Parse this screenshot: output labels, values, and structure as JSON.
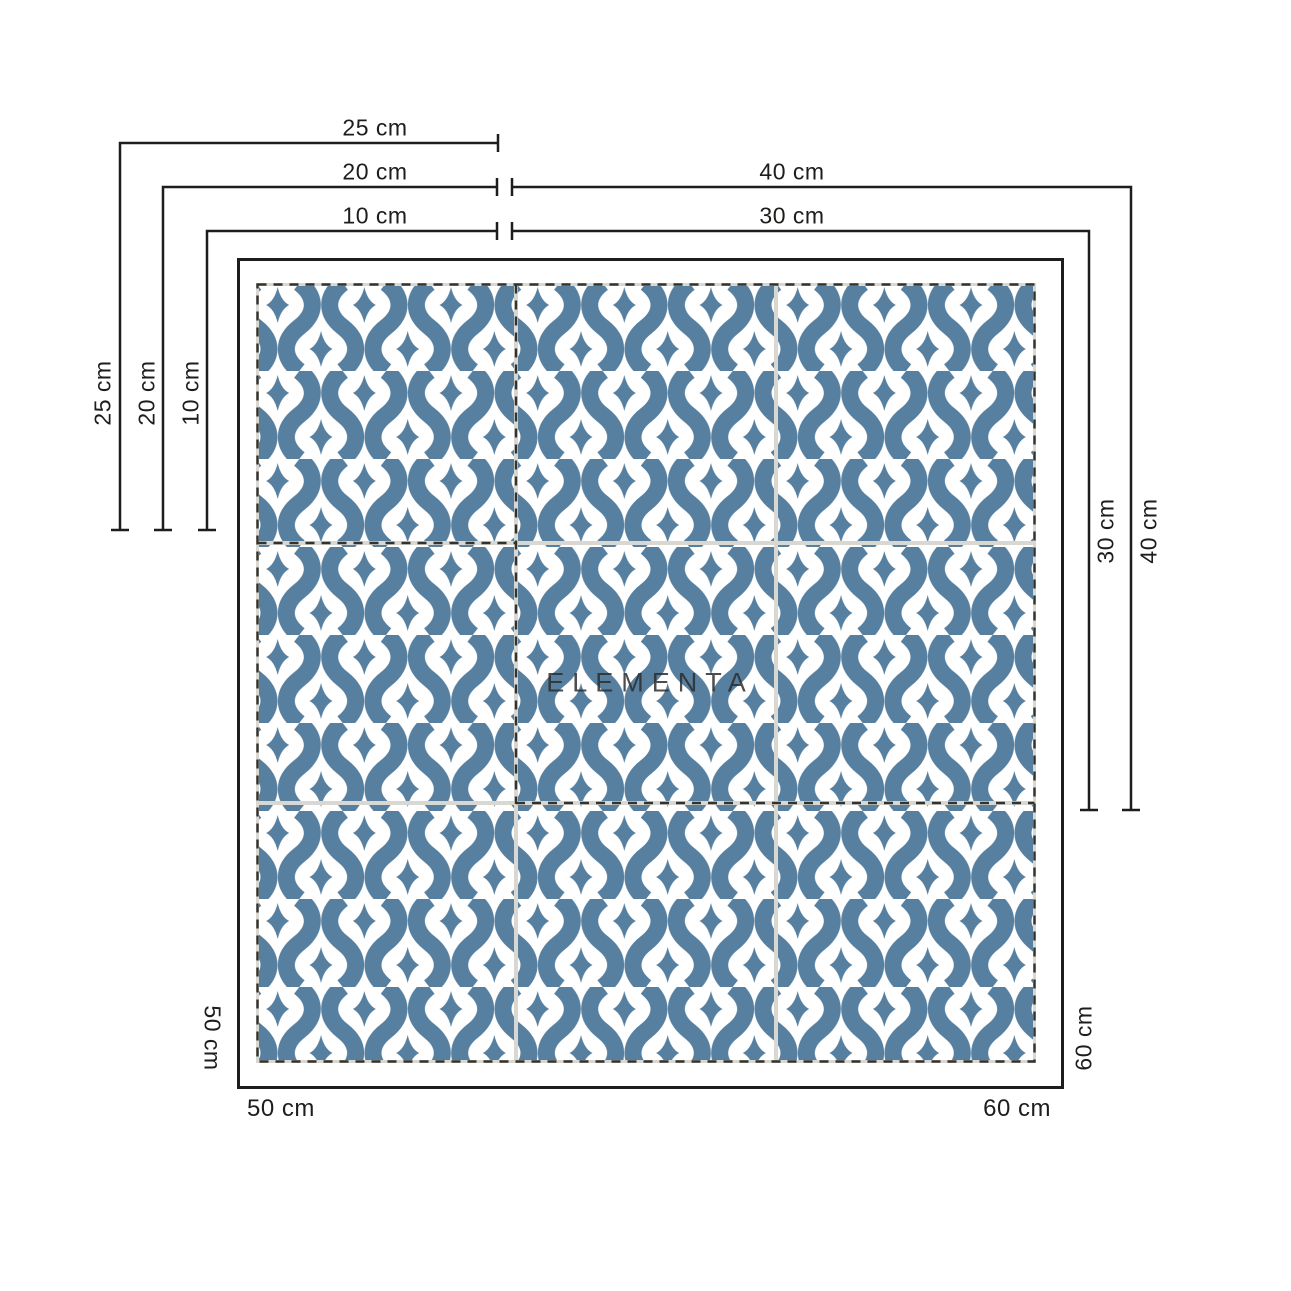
{
  "watermark": {
    "text": "ELEMENTA"
  },
  "colors": {
    "pattern_blue": "#567fa0",
    "grout_gray": "#d8d7d2",
    "line_black": "#1d1d1b",
    "dash_dark": "#33322c",
    "tile_white": "#ffffff"
  },
  "tile_sheet": {
    "grid": "3x3 tiles",
    "regions": {
      "single_tile_sizes": [
        "10 cm",
        "20 cm",
        "25 cm"
      ],
      "two_by_two_sizes": [
        "30 cm",
        "40 cm"
      ],
      "full_sheet_sizes": [
        "50 cm",
        "60 cm"
      ]
    }
  },
  "dims": {
    "top_25": "25 cm",
    "top_20": "20 cm",
    "top_10": "10 cm",
    "top_40": "40 cm",
    "top_30": "30 cm",
    "left_25": "25 cm",
    "left_20": "20 cm",
    "left_10": "10 cm",
    "right_30": "30 cm",
    "right_40": "40 cm",
    "side_left_50": "50 cm",
    "side_right_60": "60 cm",
    "bottom_50": "50 cm",
    "bottom_60": "60 cm"
  }
}
